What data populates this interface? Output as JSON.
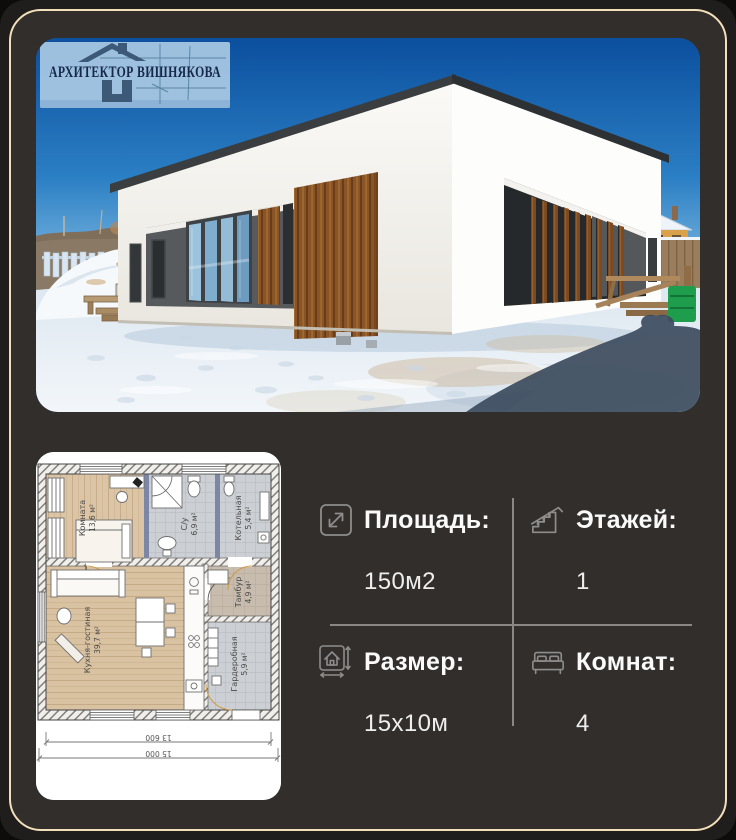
{
  "card": {
    "theme": {
      "background": "#201e1c",
      "panel": "#312e2c",
      "frame_border": "#f3dfba",
      "text": "#f7f6f4",
      "icon_gray": "#8f8d8b",
      "divider": "#8a8886",
      "wood_accent": "#8a5526",
      "sky_blue": "#2b7fc4",
      "logo_blue": "#a5c6e3",
      "logo_navy": "#16294b"
    }
  },
  "watermark": {
    "text": "АРХИТЕКТОР ВИШНЯКОВА"
  },
  "floor_plan": {
    "rooms": [
      {
        "name": "Комната",
        "area": "13,6 м²"
      },
      {
        "name": "С/у",
        "area": "6,9 м²"
      },
      {
        "name": "Котельная",
        "area": "5,4 м²"
      },
      {
        "name": "Кухня-гостиная",
        "area": "39,7 м²"
      },
      {
        "name": "Тамбур",
        "area": "4,9 м²"
      },
      {
        "name": "Гардеробная",
        "area": "5,9 м²"
      }
    ],
    "dimensions": {
      "inner": "13 600",
      "outer": "15 000"
    }
  },
  "specs": [
    {
      "label": "Площадь:",
      "value": "150м2",
      "icon": "area-expand-icon"
    },
    {
      "label": "Этажей:",
      "value": "1",
      "icon": "stairs-icon"
    },
    {
      "label": "Размер:",
      "value": "15x10м",
      "icon": "house-dimensions-icon"
    },
    {
      "label": "Комнат:",
      "value": "4",
      "icon": "bed-icon"
    }
  ]
}
